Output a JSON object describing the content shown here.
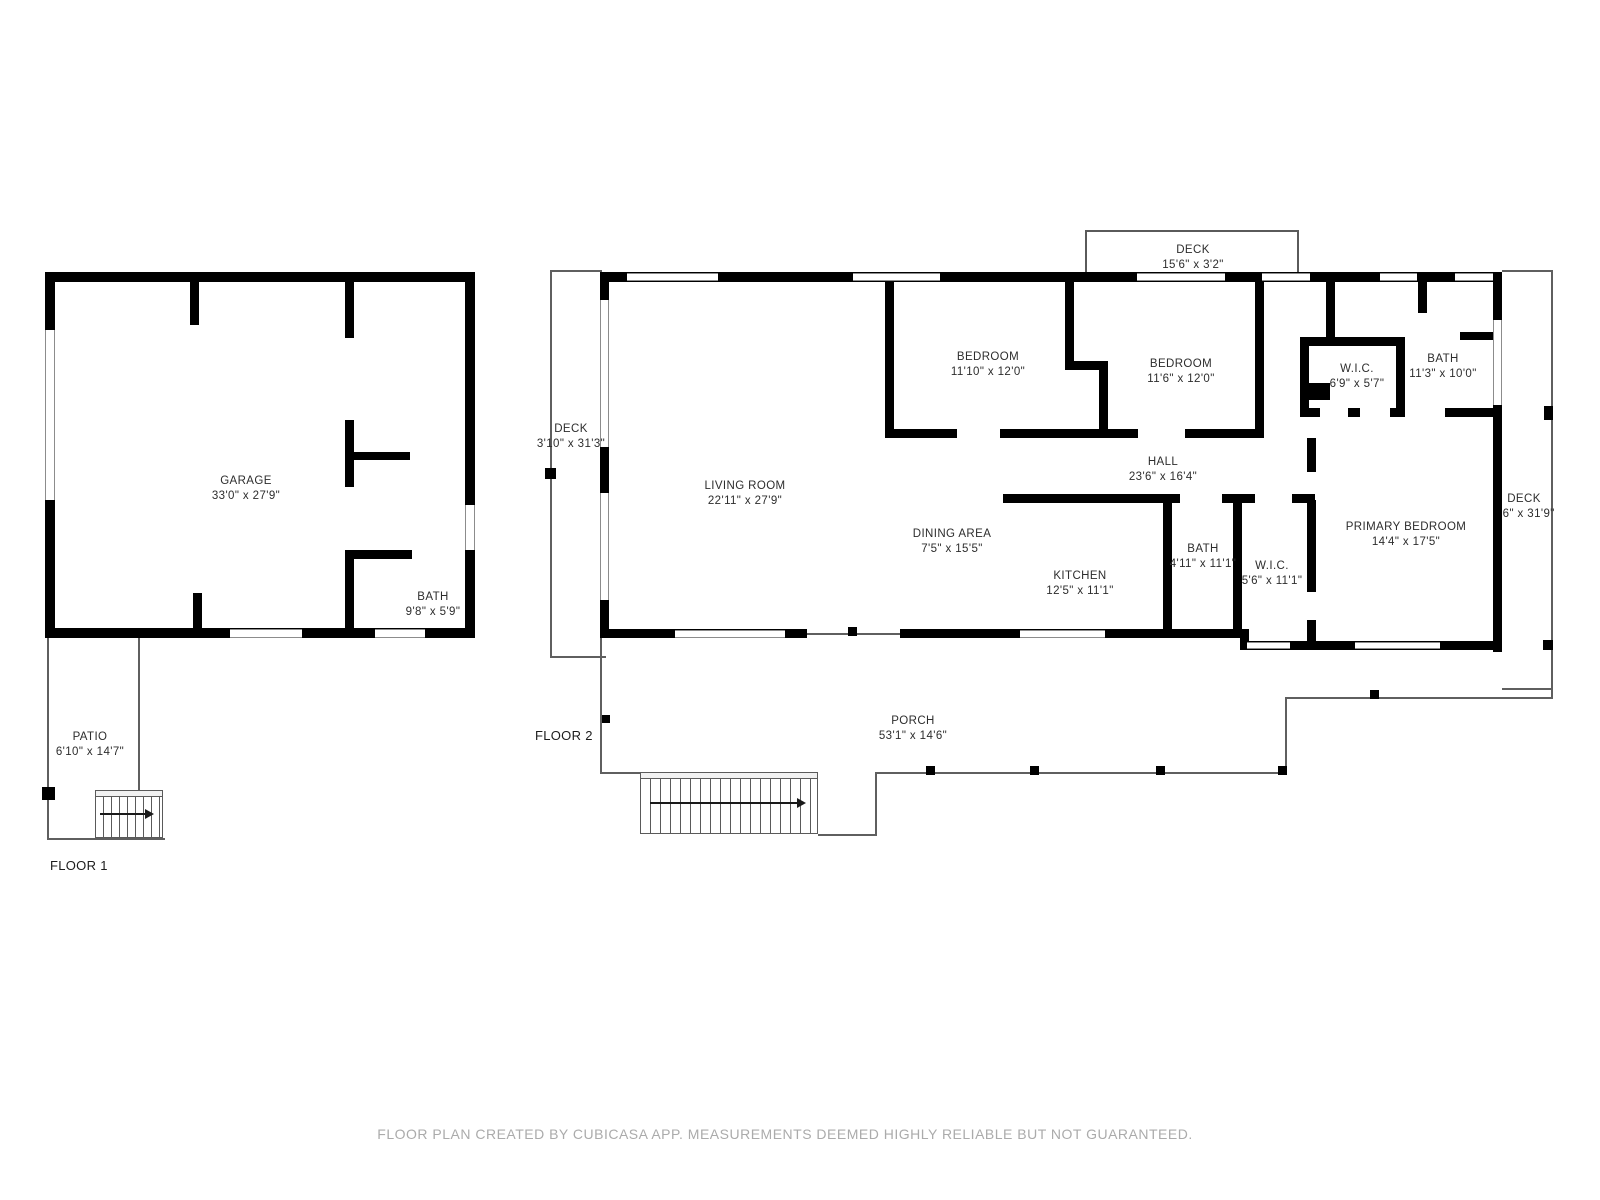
{
  "floors": {
    "floor1_label": "FLOOR 1",
    "floor2_label": "FLOOR 2"
  },
  "floor1": {
    "rooms": {
      "garage": {
        "name": "GARAGE",
        "dims": "33'0\" x 27'9\""
      },
      "bath": {
        "name": "BATH",
        "dims": "9'8\" x 5'9\""
      },
      "patio": {
        "name": "PATIO",
        "dims": "6'10\" x 14'7\""
      }
    }
  },
  "floor2": {
    "rooms": {
      "deck_top": {
        "name": "DECK",
        "dims": "15'6\" x 3'2\""
      },
      "deck_left": {
        "name": "DECK",
        "dims": "3'10\" x 31'3\""
      },
      "living_room": {
        "name": "LIVING ROOM",
        "dims": "22'11\" x 27'9\""
      },
      "bedroom_left": {
        "name": "BEDROOM",
        "dims": "11'10\" x 12'0\""
      },
      "bedroom_right": {
        "name": "BEDROOM",
        "dims": "11'6\" x 12'0\""
      },
      "wic_upper": {
        "name": "W.I.C.",
        "dims": "6'9\" x 5'7\""
      },
      "bath_upper": {
        "name": "BATH",
        "dims": "11'3\" x 10'0\""
      },
      "hall": {
        "name": "HALL",
        "dims": "23'6\" x 16'4\""
      },
      "dining_area": {
        "name": "DINING AREA",
        "dims": "7'5\" x 15'5\""
      },
      "kitchen": {
        "name": "KITCHEN",
        "dims": "12'5\" x 11'1\""
      },
      "bath_mid": {
        "name": "BATH",
        "dims": "4'11\" x 11'1\""
      },
      "wic_mid": {
        "name": "W.I.C.",
        "dims": "5'6\" x 11'1\""
      },
      "primary_bedroom": {
        "name": "PRIMARY BEDROOM",
        "dims": "14'4\" x 17'5\""
      },
      "deck_right": {
        "name": "DECK",
        "dims": "3'6\" x 31'9\""
      },
      "porch": {
        "name": "PORCH",
        "dims": "53'1\" x 14'6\""
      }
    }
  },
  "footer": {
    "disclaimer": "FLOOR PLAN CREATED BY CUBICASA APP. MEASUREMENTS DEEMED HIGHLY RELIABLE BUT NOT GUARANTEED."
  },
  "colors": {
    "wall": "#000000",
    "outline": "#5a5a5a",
    "label_text": "#2d2d2d",
    "disclaimer_text": "#ababab",
    "background": "#ffffff"
  }
}
